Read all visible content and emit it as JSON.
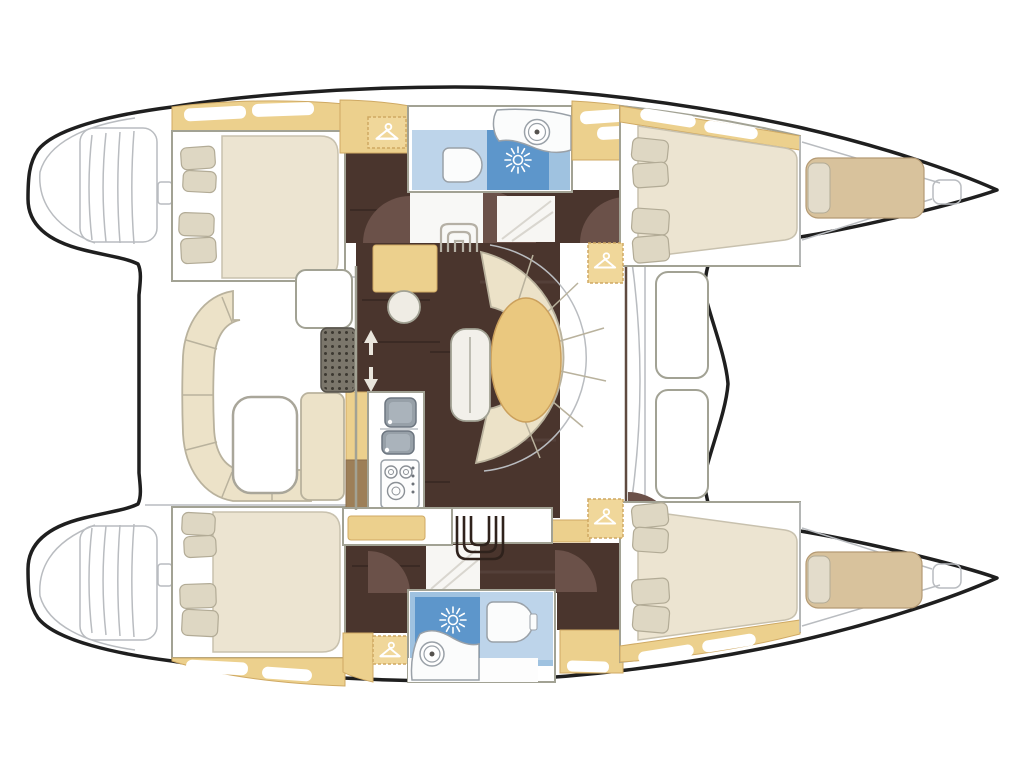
{
  "meta": {
    "type": "catamaran-deck-plan",
    "text_visible": false
  },
  "palette": {
    "outline": "#1f1f1f",
    "deck_line": "#b9bcc0",
    "cabin_line": "#a2a294",
    "floor": "#4a352d",
    "door": "#6b5149",
    "wall": "#5f4a40",
    "cream": "#ece2c8",
    "cream_line": "#b9b29d",
    "mattress": "#ece4d1",
    "mattress_line": "#c8c1ae",
    "pillow": "#ded7c3",
    "pillow_line": "#b2ab96",
    "yellow": "#ecd08d",
    "yellow_bright": "#f0d79a",
    "yellow_line": "#cfa963",
    "tan": "#d8c29c",
    "tan_line": "#b49a74",
    "tan_dark": "#9d7f58",
    "blue_pale": "#bdd4ea",
    "blue_mid": "#9fc2e0",
    "blue_deep": "#5d96cb",
    "fixture": "#fbfcfc",
    "fixture_line": "#9aa1a8",
    "sink": "#97a0a8",
    "sink_inner": "#aab3bb",
    "sink_line": "#6d7680",
    "mat": "#7b766b",
    "mat_dot": "#3c3831",
    "table": "#eac87f",
    "table_line": "#cba05c",
    "step_dark": "#2f221c",
    "step_light": "#b5b0a5"
  },
  "rooms": [
    {
      "id": "salon",
      "label": "salon-dinette",
      "features": [
        "oval-dining-table",
        "curved-settee",
        "bench-seat",
        "nav-table",
        "round-stool"
      ]
    },
    {
      "id": "galley",
      "label": "galley",
      "features": [
        "double-sink",
        "stove-burners",
        "counter",
        "lockers"
      ]
    },
    {
      "id": "cockpit",
      "label": "aft-cockpit",
      "features": [
        "c-shaped-bench",
        "cockpit-table",
        "grate-mat",
        "entry-arrows"
      ]
    },
    {
      "id": "port-aft-cabin",
      "label": "port-aft-double-cabin",
      "features": [
        "double-berth",
        "pillows",
        "shelf-lockers",
        "wardrobe"
      ]
    },
    {
      "id": "port-head",
      "label": "port-head",
      "features": [
        "toilet",
        "shower",
        "washbasin"
      ]
    },
    {
      "id": "port-forward-cabin",
      "label": "port-forward-double-cabin",
      "features": [
        "tapered-double-berth",
        "pillows",
        "shelf-lockers",
        "wardrobe"
      ]
    },
    {
      "id": "port-forepeak",
      "label": "port-forepeak-berth",
      "features": [
        "single-berth",
        "pillow"
      ]
    },
    {
      "id": "starboard-aft-cabin",
      "label": "starboard-aft-double-cabin",
      "features": [
        "double-berth",
        "pillows",
        "shelf-lockers",
        "wardrobe"
      ]
    },
    {
      "id": "starboard-head",
      "label": "starboard-head",
      "features": [
        "toilet",
        "shower",
        "washbasin"
      ]
    },
    {
      "id": "starboard-forward-cabin",
      "label": "starboard-forward-double-cabin",
      "features": [
        "tapered-double-berth",
        "pillows",
        "shelf-lockers",
        "wardrobe"
      ]
    },
    {
      "id": "starboard-forepeak",
      "label": "starboard-forepeak-berth",
      "features": [
        "single-berth",
        "pillow"
      ]
    },
    {
      "id": "foredeck",
      "label": "foredeck-lockers",
      "features": [
        "deck-hatches",
        "anchor-locker"
      ]
    },
    {
      "id": "transoms",
      "label": "transom-swim-steps",
      "features": [
        "molded-steps"
      ]
    }
  ],
  "icons": [
    {
      "name": "hanger-icon",
      "count": 4,
      "meaning": "wardrobe"
    },
    {
      "name": "shower-icon",
      "count": 2,
      "meaning": "shower-rose"
    },
    {
      "name": "toilet-icon",
      "count": 2,
      "meaning": "marine-toilet"
    },
    {
      "name": "washbasin-icon",
      "count": 2,
      "meaning": "vanity-sink"
    },
    {
      "name": "galley-sink-icon",
      "count": 2,
      "meaning": "sink"
    },
    {
      "name": "stove-icon",
      "count": 1,
      "meaning": "burners"
    },
    {
      "name": "companionway-steps-icon",
      "count": 2,
      "meaning": "steps-down-to-hull"
    },
    {
      "name": "door-swing-icon",
      "count": 6,
      "meaning": "door"
    },
    {
      "name": "up-down-arrows-icon",
      "count": 1,
      "meaning": "sliding-door-entry"
    }
  ]
}
